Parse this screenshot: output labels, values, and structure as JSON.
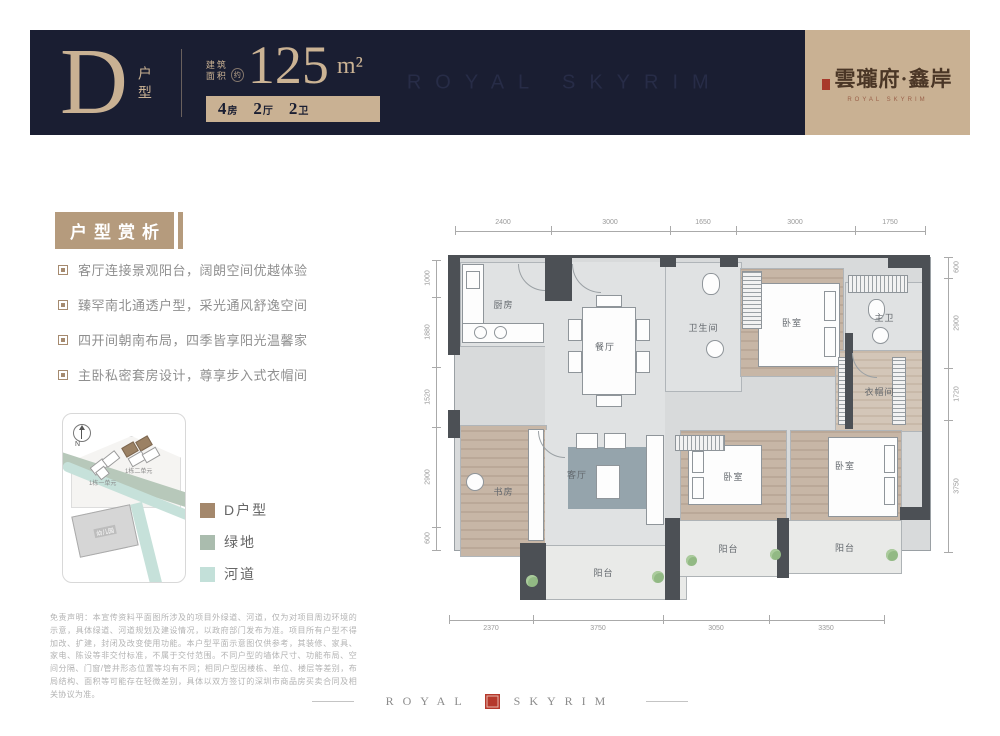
{
  "header": {
    "type_letter": "D",
    "type_label": "户型",
    "area_label_line1": "建筑",
    "area_label_line2": "面积",
    "area_approx": "约",
    "area_value": "125",
    "area_unit": "m²",
    "specs": [
      {
        "num": "4",
        "unit": "房"
      },
      {
        "num": "2",
        "unit": "厅"
      },
      {
        "num": "2",
        "unit": "卫"
      }
    ],
    "watermark": "ROYAL SKYRIM",
    "brand": {
      "name_cn": "雲瓏府·鑫岸",
      "name_en": "ROYAL SKYRIM"
    },
    "colors": {
      "navy": "#1a1e32",
      "tan": "#c9b193"
    }
  },
  "analysis": {
    "title": "户型赏析",
    "bullets": [
      "客厅连接景观阳台，阔朗空间优越体验",
      "臻罕南北通透户型，采光通风舒逸空间",
      "四开间朝南布局，四季皆享阳光温馨家",
      "主卧私密套房设计，尊享步入式衣帽间"
    ]
  },
  "siteplan": {
    "north": "N",
    "buildings": [
      "1栋一单元",
      "1栋二单元"
    ],
    "school": "幼儿园",
    "legend": [
      {
        "label": "D户型",
        "color": "#a4886c"
      },
      {
        "label": "绿地",
        "color": "#aabcae"
      },
      {
        "label": "河道",
        "color": "#c3e0d9"
      }
    ]
  },
  "disclaimer": "免责声明：本宣传资料平面图所涉及的项目外绿道、河道，仅为对项目周边环境的示意，具体绿道、河道规划及建设情况，以政府部门发布为准。项目所有户型不得加改、扩建，封闭及改变使用功能。本户型平面示意图仅供参考，其装修、家具、家电、陈设等非交付标准，不属于交付范围。不同户型的墙体尺寸、功能布局、空间分隔、门窗/管井形态位置等均有不同；相同户型因楼栋、单位、楼层等差别，布局结构、面积等可能存在轻微差别，具体以双方签订的深圳市商品房买卖合同及相关协议为准。",
  "floorplan": {
    "rooms": {
      "kitchen": "厨房",
      "dining": "餐厅",
      "bath": "卫生间",
      "bedroom_top": "卧室",
      "master_bath": "主卫",
      "cloakroom": "衣帽间",
      "study": "书房",
      "living": "客厅",
      "bedroom_mid": "卧室",
      "bedroom_right": "卧室",
      "balcony_living": "阳台",
      "balcony_mid": "阳台",
      "balcony_right": "阳台"
    },
    "dims_top": [
      "2400",
      "3000",
      "1650",
      "3000",
      "1750"
    ],
    "dims_bottom": [
      "2370",
      "3750",
      "3050",
      "3350"
    ],
    "dims_left": [
      "1000",
      "1880",
      "1520",
      "2900",
      "600"
    ],
    "dims_right": [
      "600",
      "2900",
      "1720",
      "3750"
    ]
  },
  "footer": {
    "word_left": "ROYAL",
    "word_right": "SKYRIM"
  }
}
